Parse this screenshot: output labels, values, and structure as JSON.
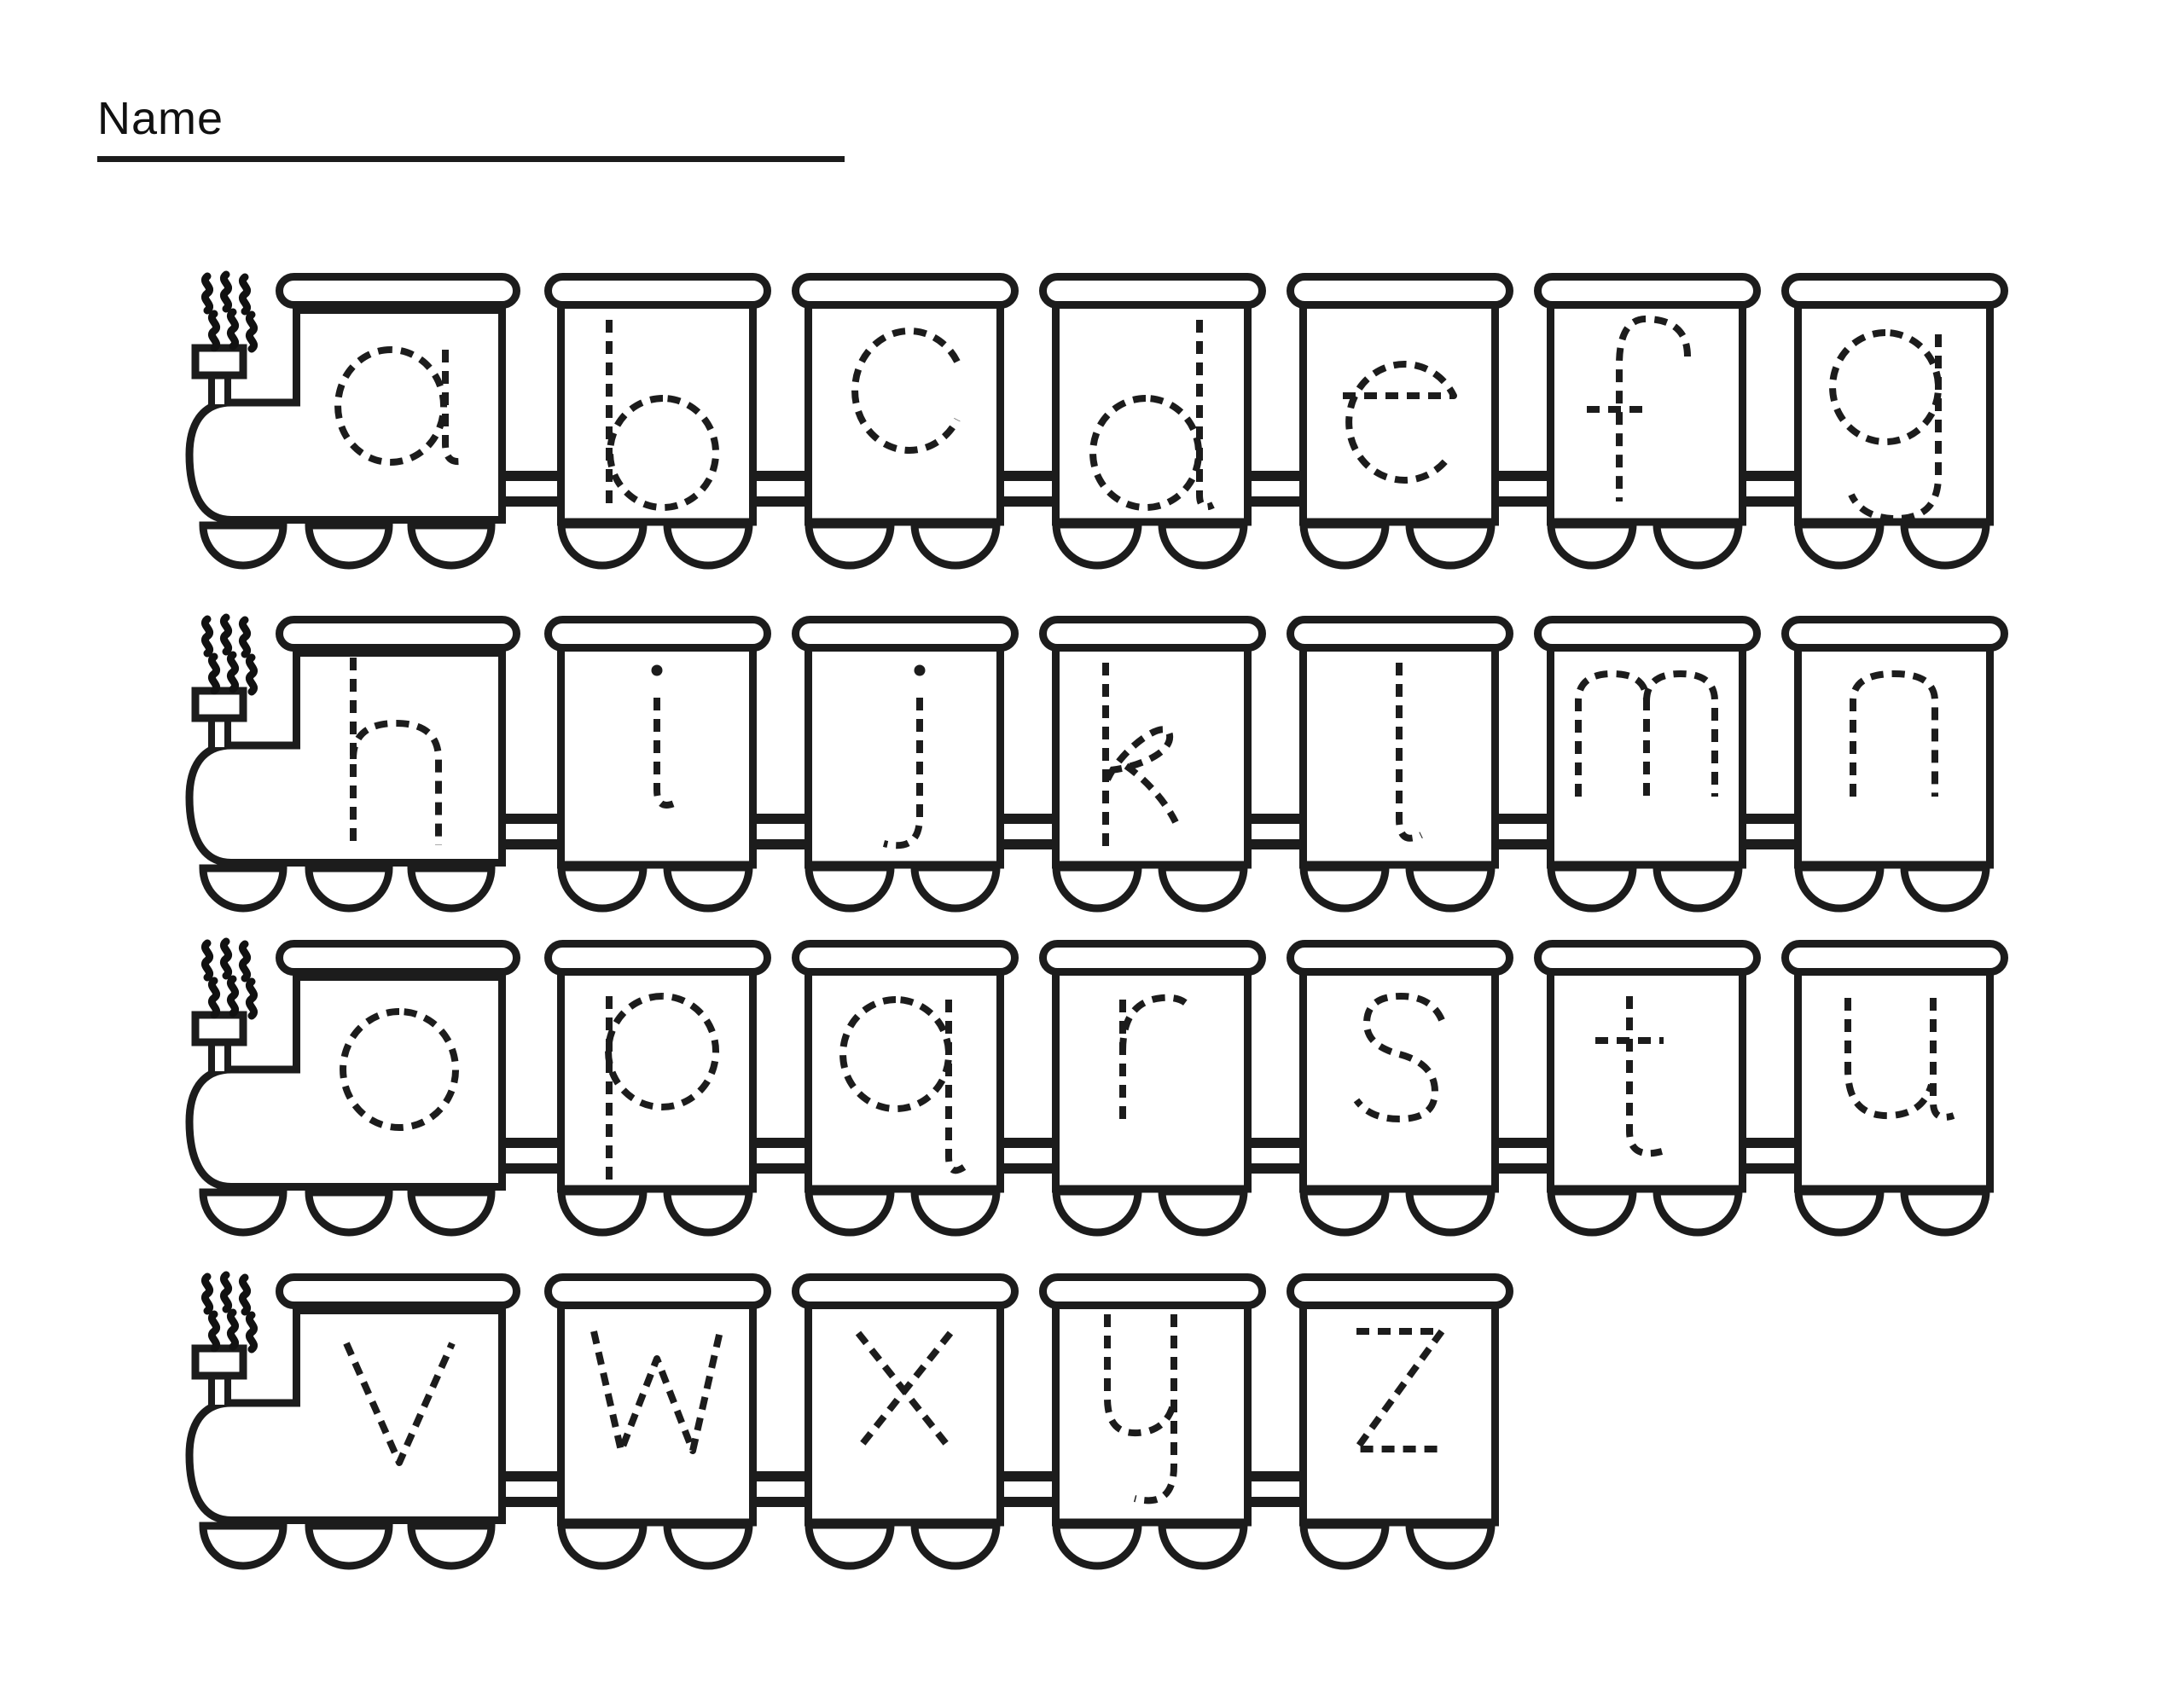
{
  "header": {
    "name_label": "Name"
  },
  "colors": {
    "ink": "#1c1c1c",
    "paper": "#ffffff"
  },
  "trains": [
    {
      "engine": "a",
      "cars": [
        "b",
        "c",
        "d",
        "e",
        "f",
        "g"
      ]
    },
    {
      "engine": "h",
      "cars": [
        "i",
        "j",
        "k",
        "l",
        "m",
        "n"
      ]
    },
    {
      "engine": "o",
      "cars": [
        "p",
        "q",
        "r",
        "s",
        "t",
        "u"
      ]
    },
    {
      "engine": "v",
      "cars": [
        "w",
        "x",
        "y",
        "z"
      ]
    }
  ]
}
